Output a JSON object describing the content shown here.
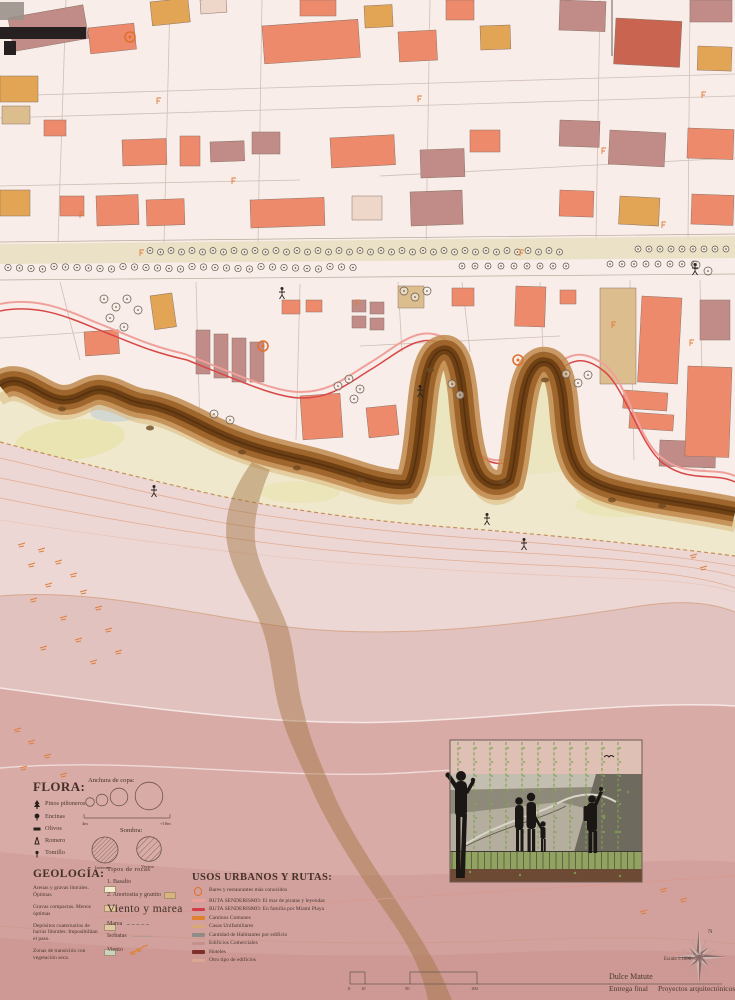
{
  "sheet": {
    "escala": "Escala 1:1000",
    "author": "Dulce Matute",
    "entrega": "Entrega final",
    "course": "Proyectos arquitectónicos 2",
    "north": "N",
    "scale_ticks": [
      "0",
      "10",
      "50",
      "100"
    ]
  },
  "legends": {
    "flora": {
      "title": "FLORA:",
      "items": [
        "Pinos piñoneros",
        "Encinas",
        "Olivos",
        "Romero",
        "Tomillo"
      ],
      "anchura": {
        "title": "Anchura de copa:",
        "min": "4m",
        "max": "+10m"
      },
      "sombra": {
        "title": "Sombra:",
        "labels": [
          "Invierno",
          "Verano"
        ]
      }
    },
    "geologia": {
      "title": "GEOLOGÍA:",
      "items": [
        "Arenas y gravas litorales. Óptimas",
        "Gravas compactas. Menos óptimas",
        "Depósitos cuaternarios de barras litorales. Imposibilitan el paso.",
        "Zonas de transición con vegetación seca."
      ]
    },
    "rocas": {
      "title": "Tipos de rocas",
      "items": [
        "1. Basalto",
        "2. Anortosita y granito"
      ]
    },
    "viento": {
      "title": "Viento y marea",
      "items": [
        "Marea",
        "Isobatas",
        "Viento"
      ]
    },
    "usos": {
      "title": "USOS URBANOS Y RUTAS:",
      "items": [
        "Bares y restaurantes más conocidos",
        "RUTA SENDERISMO: El mar de piratas y leyendas",
        "RUTA SENDERISMO: En familia por Miami Playa",
        "Caminos Comunes",
        "Casas Unifamiliares",
        "Cantidad de Habitantes por edificio",
        "Edificios Comerciales",
        "Hoteles",
        "Otro tipo de edificios"
      ]
    }
  },
  "colors": {
    "ruta_piratas": "#f0a09a",
    "ruta_familia": "#d33d4a",
    "caminos_comunes": "#e0812f",
    "casas_unifamiliares": "#d9a876",
    "habitantes_edificio": "#8f8b86",
    "edificios_comerciales": "#c4908d",
    "hoteles": "#7e2f2a",
    "otro_tipo": "#d8a893",
    "bares_marker": "#e0702d",
    "cliff": "#9a6128",
    "beach": "#efe8cc",
    "sea_deep": "#d2a19d"
  }
}
